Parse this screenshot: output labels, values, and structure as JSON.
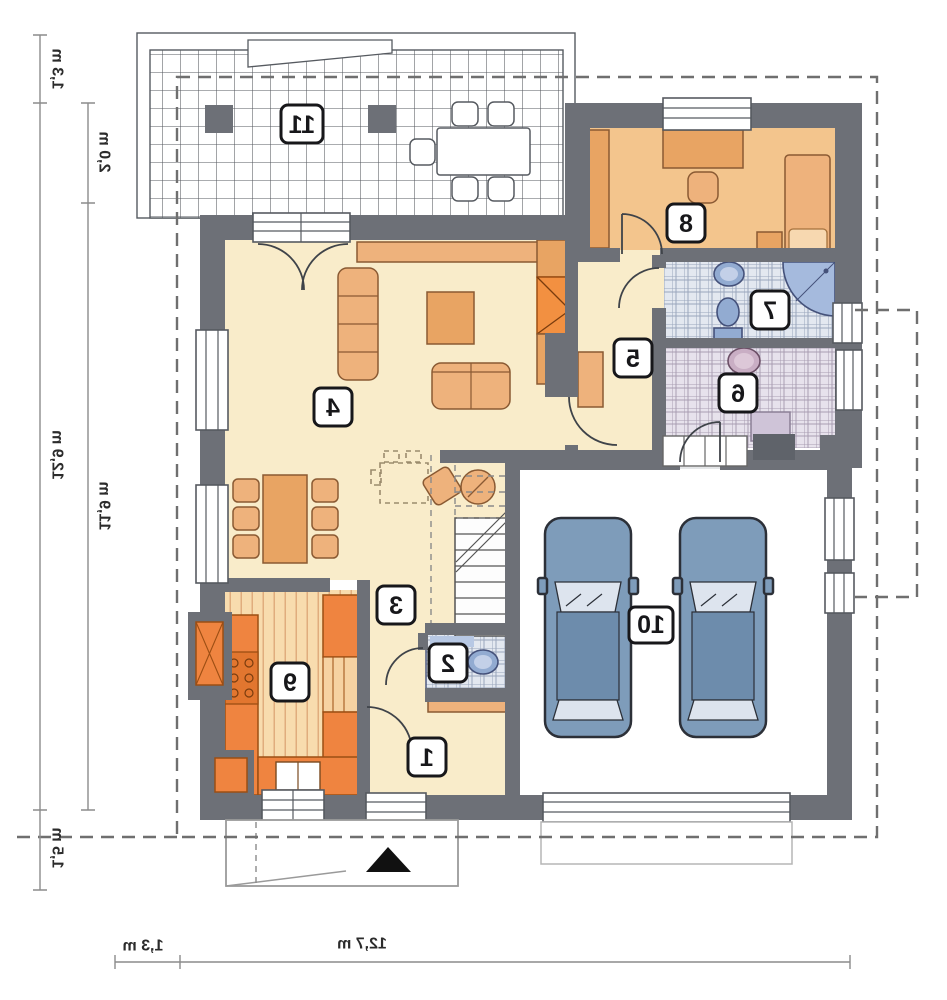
{
  "figure": {
    "kind": "house-floor-plan",
    "appearance": "horizontally-mirrored architectural drawing"
  },
  "rooms": [
    {
      "number": "1"
    },
    {
      "number": "2"
    },
    {
      "number": "3"
    },
    {
      "number": "4"
    },
    {
      "number": "5"
    },
    {
      "number": "6"
    },
    {
      "number": "7"
    },
    {
      "number": "8"
    },
    {
      "number": "9"
    },
    {
      "number": "10"
    },
    {
      "number": "11"
    }
  ],
  "dimensions": {
    "side_overhang": "1,3 m",
    "terrace_depth": "2,0 m",
    "side_total": "12,9 m",
    "side_inner": "11,9 m",
    "side_porch": "1,5 m",
    "bottom_overhang": "1,3 m",
    "bottom_total": "12,7 m"
  },
  "colors": {
    "wall": "#6d7077",
    "floor": "#f9ecca",
    "bedroom": "#f3c58d",
    "furniture": "#eeb27c",
    "furniture_dark": "#e8a463",
    "orange": "#ef8440",
    "stair_orange": "#f29041",
    "kitchen_floor": "#f8dcae",
    "kitchen_stripe": "#e0ad7d",
    "tile_blue": "#e3e8f0",
    "tile_blue_line": "#9aa6bc",
    "fixture_blue": "#92abd1",
    "shower_blue": "#a5badd",
    "tile_purple": "#e7e2ec",
    "tile_purple_line": "#a99db2",
    "fixture_purple": "#c9aec4",
    "washer": "#cfc4d8",
    "car_body": "#7e9cba",
    "car_dark": "#6d8cac",
    "car_glass": "#dde4ee",
    "grid_line": "#55595f",
    "dash": "#6f6f6f",
    "dim": "#8c8c8c"
  }
}
